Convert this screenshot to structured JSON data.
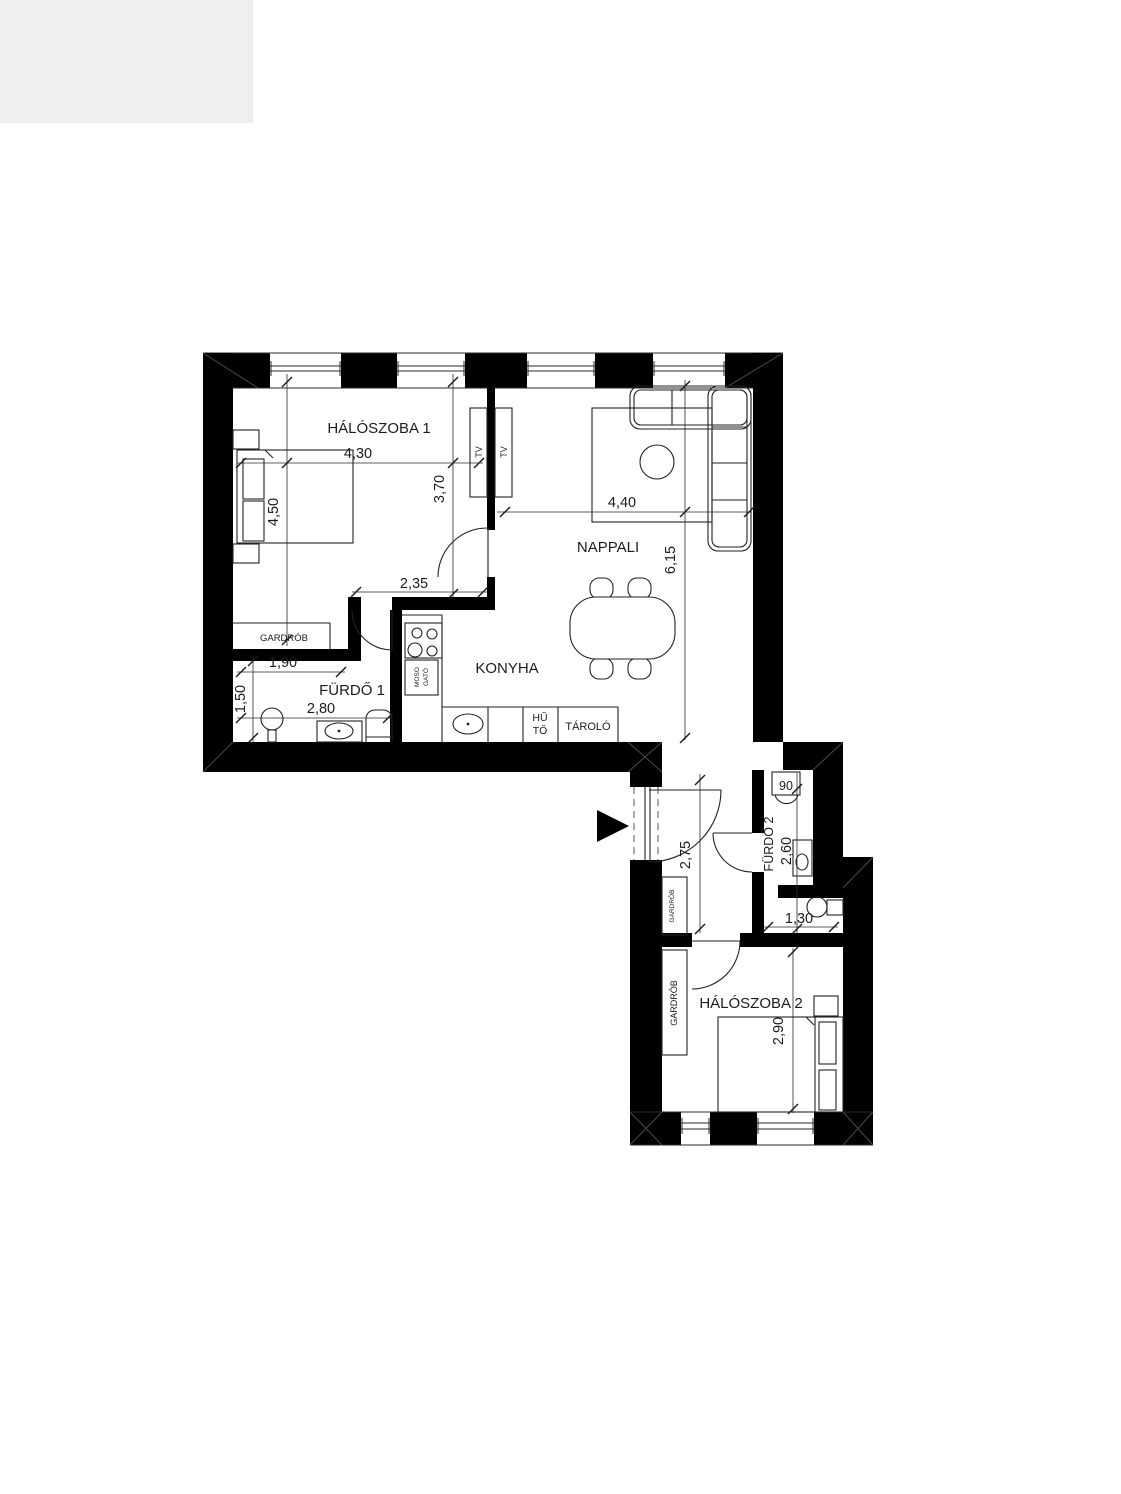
{
  "plan": {
    "rooms": {
      "bedroom1": "HÁLÓSZOBA 1",
      "living_room": "NAPPALI",
      "kitchen": "KONYHA",
      "bathroom1": "FÜRDŐ 1",
      "bathroom2": "FÜRDŐ 2",
      "bedroom2": "HÁLÓSZOBA 2",
      "wardrobe_bedroom1": "GARDRÓB",
      "wardrobe_hall": "GARDRÓB",
      "wardrobe_bedroom2": "GARDRÓB"
    },
    "fixtures": {
      "tv_bedroom_side": "TV",
      "tv_living_side": "TV",
      "sink_cabinet_line1": "MOSO",
      "sink_cabinet_line2": "GATÓ",
      "fridge_line1": "HŰ",
      "fridge_line2": "TŐ",
      "storage": "TÁROLÓ",
      "washbasin_width": "90"
    },
    "dims": {
      "d430": "4,30",
      "d450": "4,50",
      "d370": "3,70",
      "d235": "2,35",
      "d440": "4,40",
      "d615": "6,15",
      "d190": "1,90",
      "d150": "1,50",
      "d280": "2,80",
      "d275": "2,75",
      "d260": "2,60",
      "d130": "1,30",
      "d290": "2,90"
    },
    "colors": {
      "wall": "#000000",
      "line": "#1c1c1c",
      "paper": "#ffffff",
      "corner_tint": "#efefef"
    }
  }
}
